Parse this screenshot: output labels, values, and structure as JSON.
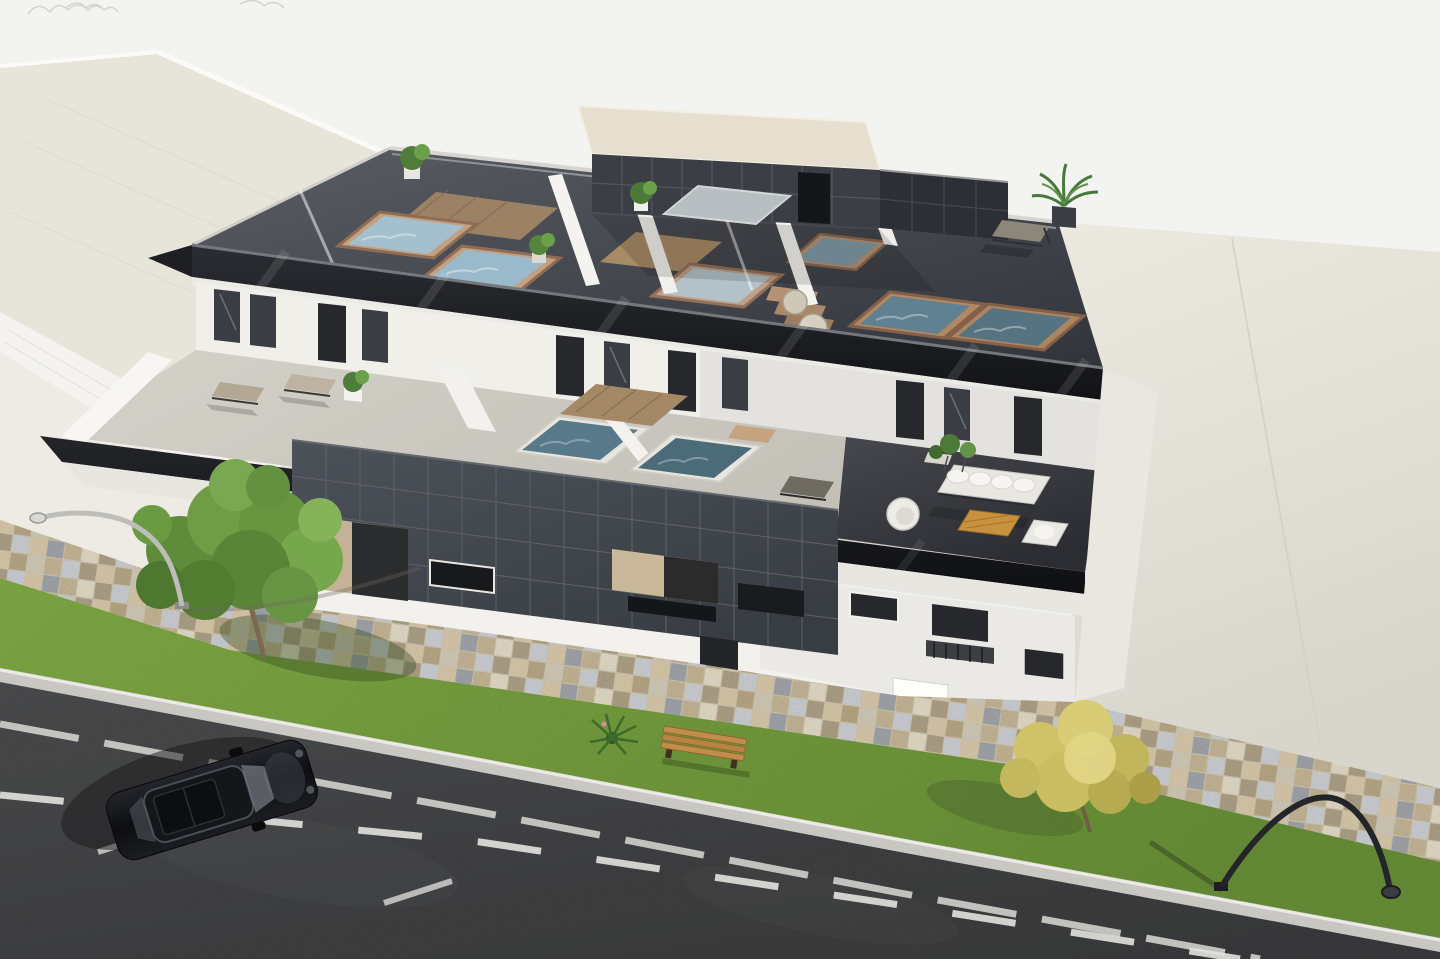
{
  "scene": {
    "title": "Aerial 3D architectural rendering of a modern apartment building with private rooftop plunge pools",
    "description": "Axonometric aerial view of a white three-storey residential building with anthracite tile cladding, glass balustrades, rooftop terraces with plunge pools, second-floor terraces with loungers and an outdoor sofa set, a paved sidewalk with grass strips, two trees, a bench, two street lamps and a black car parked on the asphalt street.",
    "palette": {
      "sky": "#f3f3f1",
      "neighbor_roof": "#e7e4da",
      "apron_concrete": "#e4e1d8",
      "facade_white": "#f2f1ed",
      "cladding_anthracite": "#44484f",
      "balustrade_glass_dark": "#1b1d22",
      "roof_deck": "#3f434a",
      "pool_water_light": "#a4c0ce",
      "pool_water_dark": "#4c6b79",
      "pool_coping_brick": "#c2a183",
      "wood_deck": "#9b8265",
      "terrace_floor": "#cbc8c0",
      "sofa_white": "#e9e7e2",
      "coffee_table_wood": "#c8913f",
      "grass": "#7da544",
      "asphalt": "#454749",
      "road_marking": "#e2e2de",
      "paver_tan": "#d6c6a8",
      "paver_gray": "#9fa3a8",
      "car_black": "#0d0e11",
      "tree_green": "#6f9c44",
      "tree_yellow": "#d8cc77"
    },
    "inventory": {
      "rooftop_pools": 6,
      "terrace_pools": 2,
      "sun_loungers": 4,
      "sofa_sets": 1,
      "coffee_tables": 1,
      "pouf_seats": 2,
      "potted_plants": 8,
      "benches": 1,
      "street_lamps": 2,
      "cars": 1,
      "green_trees": 1,
      "yellow_trees": 1
    }
  }
}
